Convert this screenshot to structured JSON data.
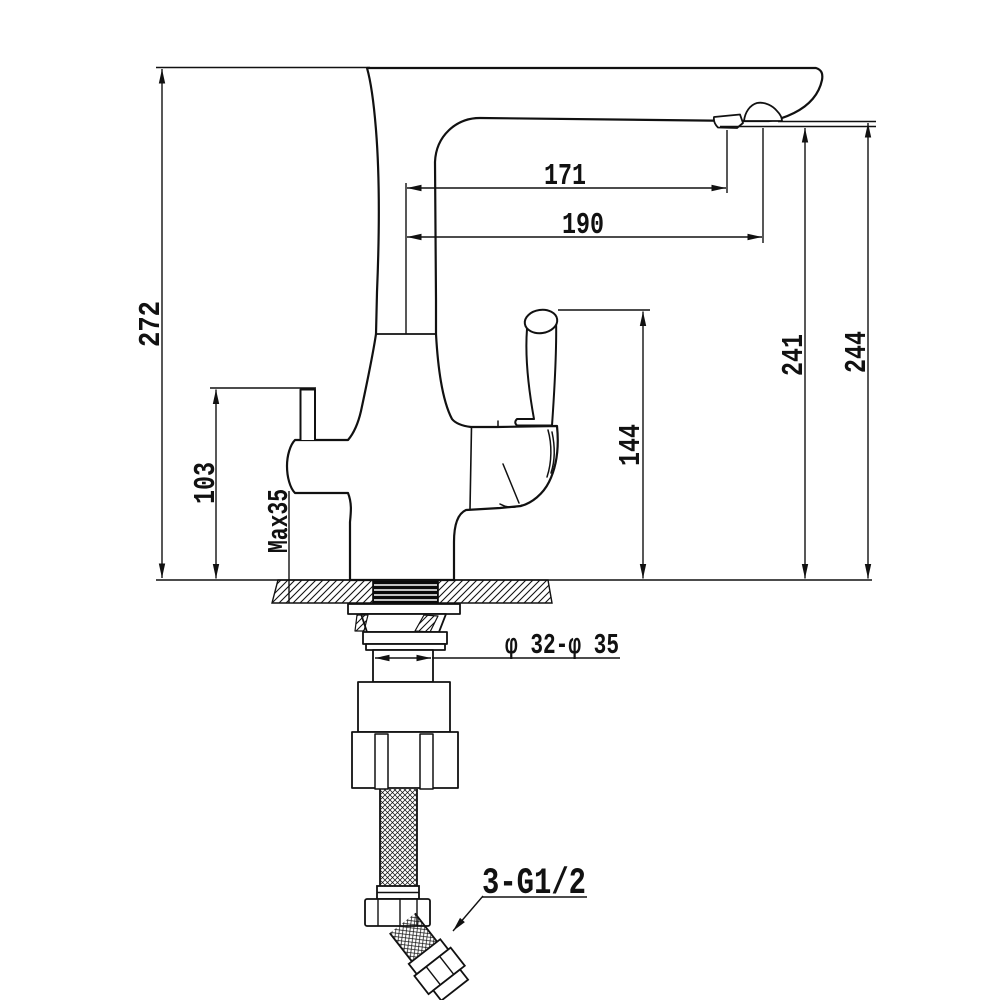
{
  "drawing": {
    "type": "faucet-installation-dimension-drawing",
    "dims": {
      "overall_height": "272",
      "spout_reach_inner": "171",
      "spout_reach_outer": "190",
      "spout_height_inner": "241",
      "spout_height_outer": "244",
      "side_lever_height": "103",
      "max_deck_thickness": "Max35",
      "handle_height": "144",
      "mounting_hole_diameter": "φ 32-φ 35",
      "hose_connection_thread": "3-G1/2"
    },
    "colors": {
      "line": "#111111",
      "background": "#ffffff",
      "thread_block": "#0a0a0a"
    }
  }
}
